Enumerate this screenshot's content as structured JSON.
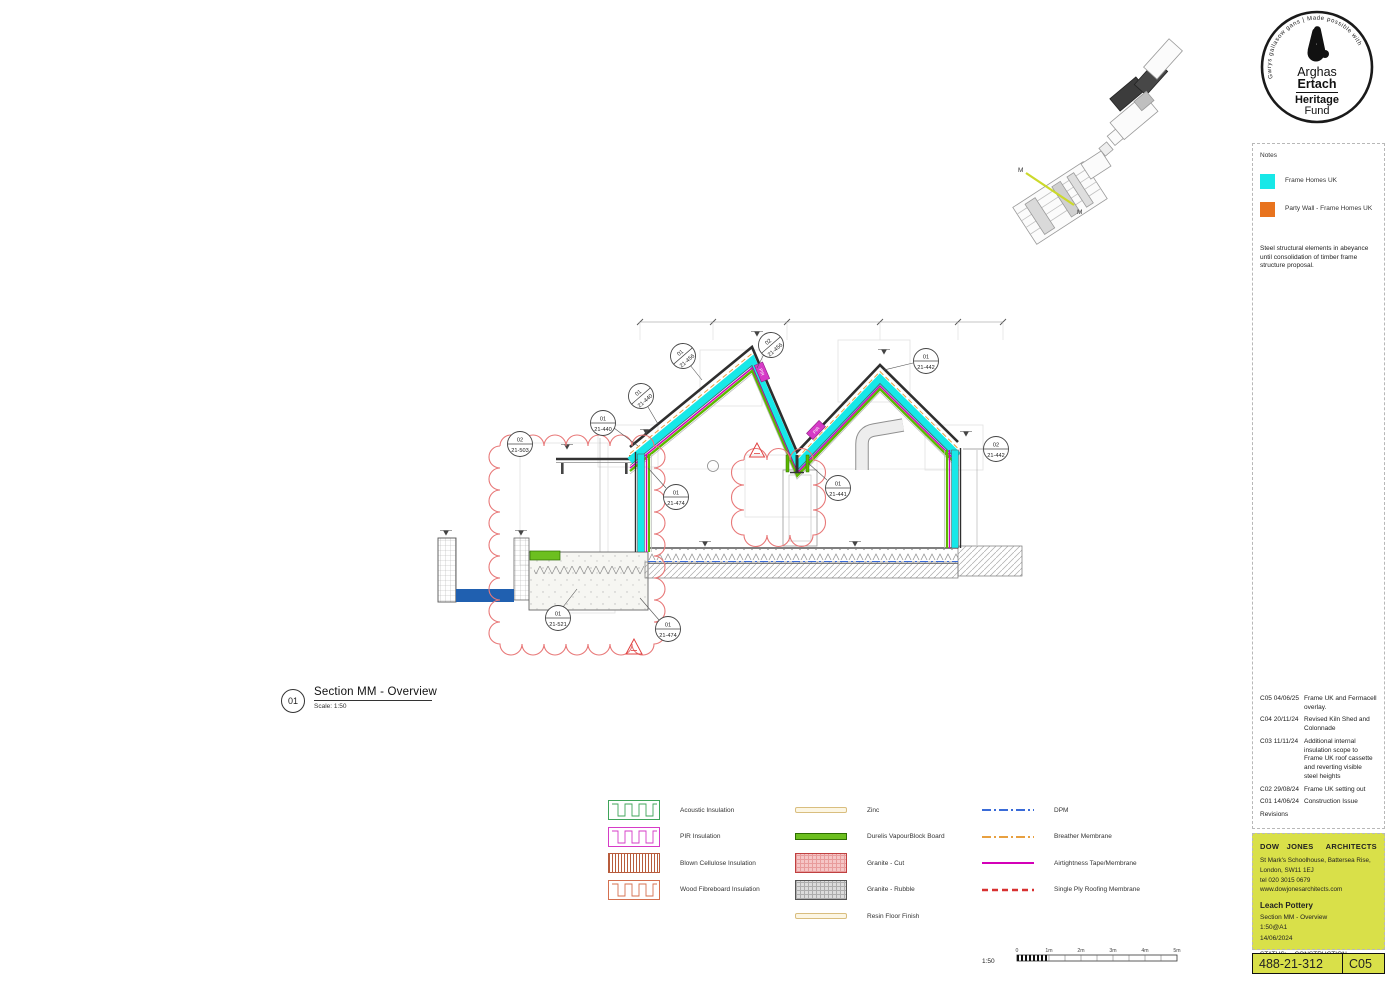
{
  "logo": {
    "ring_text": "Gwrys gallasow gans | Made possible with",
    "name_line1": "Arghas",
    "name_line2": "Ertach",
    "fund_line1": "Heritage",
    "fund_line2": "Fund"
  },
  "notes": {
    "title": "Notes",
    "swatches": [
      {
        "label": "Frame Homes UK",
        "color": "#17E8E8"
      },
      {
        "label": "Party Wall - Frame Homes UK",
        "color": "#E8731E"
      }
    ],
    "body": "Steel structural elements in abeyance until consolidation of timber frame structure proposal."
  },
  "revisions": {
    "label": "Revisions",
    "items": [
      {
        "code": "C05 04/06/25",
        "desc": "Frame UK and Fermacell overlay."
      },
      {
        "code": "C04 20/11/24",
        "desc": "Revised Kiln Shed and Colonnade"
      },
      {
        "code": "C03 11/11/24",
        "desc": "Additional internal insulation scope to Frame UK roof cassette and reverting visible steel heights"
      },
      {
        "code": "C02 29/08/24",
        "desc": "Frame UK setting out"
      },
      {
        "code": "C01 14/06/24",
        "desc": "Construction Issue"
      }
    ]
  },
  "title_block": {
    "firm_left": "DOW JONES",
    "firm_right": "ARCHITECTS",
    "address1": "St Mark's Schoolhouse, Battersea Rise,",
    "address2": "London, SW11 1EJ",
    "tel": "tel 020 3015 0679",
    "web": "www.dowjonesarchitects.com",
    "project": "Leach Pottery",
    "drawing_title": "Section MM - Overview",
    "scale": "1:50@A1",
    "date": "14/06/2024",
    "status_label": "STATUS:",
    "status_value": "CONSTRUCTION"
  },
  "drawing_number": {
    "number": "488-21-312",
    "revision": "C05"
  },
  "section_label": {
    "number": "01",
    "title": "Section MM - Overview",
    "scale": "Scale: 1:50"
  },
  "scale_bar": {
    "ratio": "1:50",
    "ticks": [
      "0",
      "1m",
      "2m",
      "3m",
      "4m",
      "5m"
    ]
  },
  "key_plan": {
    "marker": "M"
  },
  "materials_legend": {
    "col1": [
      {
        "label": "Acoustic Insulation",
        "swatch": "batt-green"
      },
      {
        "label": "PIR Insulation",
        "swatch": "batt-magenta"
      },
      {
        "label": "Blown Cellulose Insulation",
        "swatch": "hatch-red"
      },
      {
        "label": "Wood Fibreboard Insulation",
        "swatch": "batt-orange"
      }
    ],
    "col2": [
      {
        "label": "Zinc",
        "swatch": "bar-cream"
      },
      {
        "label": "Durelis VapourBlock Board",
        "swatch": "bar-green"
      },
      {
        "label": "Granite - Cut",
        "swatch": "grid-pink"
      },
      {
        "label": "Granite - Rubble",
        "swatch": "grid-gray"
      },
      {
        "label": "Resin Floor Finish",
        "swatch": "bar-cream"
      }
    ],
    "col3": [
      {
        "label": "DPM",
        "swatch": "line-dashdot-blue"
      },
      {
        "label": "Breather Membrane",
        "swatch": "line-dashdot-orange"
      },
      {
        "label": "Airtightness Tape/Membrane",
        "swatch": "line-solid-magenta"
      },
      {
        "label": "Single Ply Roofing Membrane",
        "swatch": "line-dashed-red"
      }
    ]
  },
  "drawing": {
    "pir_label": "PIR",
    "callouts": [
      {
        "top": "02",
        "bottom": "21-503"
      },
      {
        "top": "01",
        "bottom": "21-440"
      },
      {
        "top": "01",
        "bottom": "21-440"
      },
      {
        "top": "01",
        "bottom": "21-456"
      },
      {
        "top": "02",
        "bottom": "21-456"
      },
      {
        "top": "01",
        "bottom": "21-442"
      },
      {
        "top": "02",
        "bottom": "21-442"
      },
      {
        "top": "01",
        "bottom": "21-474"
      },
      {
        "top": "01",
        "bottom": "21-441"
      },
      {
        "top": "01",
        "bottom": "21-521"
      },
      {
        "top": "01",
        "bottom": "21-474"
      }
    ]
  },
  "colors": {
    "frame_cyan": "#17E8E8",
    "party_wall_orange": "#E8731E",
    "title_block_yellow": "#D9E049",
    "revision_cloud_red": "#E87878",
    "water_blue": "#2060B0",
    "durelis_green": "#5CB800",
    "airtightness_magenta": "#D400B8",
    "dpm_blue": "#3A6BD8",
    "breather_orange": "#E8A040",
    "single_ply_red": "#D83030"
  }
}
